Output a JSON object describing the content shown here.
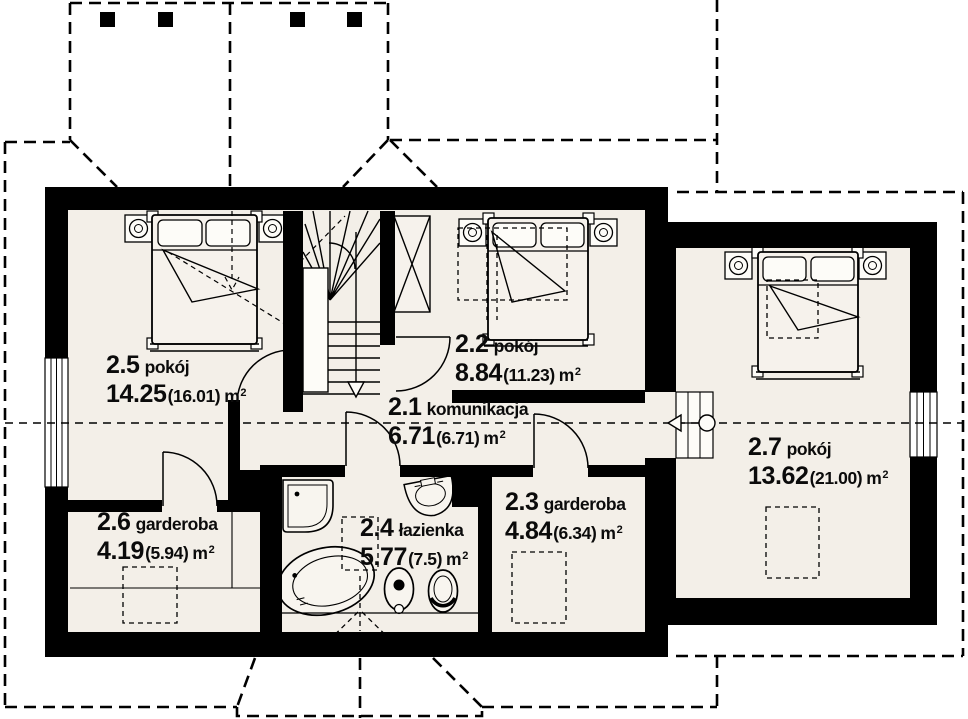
{
  "plan": {
    "drawing_title": "attic floor plan",
    "unit": "m",
    "unit_sup": "2",
    "colors": {
      "wall": "#000000",
      "floor": "#f3efe8",
      "background": "#ffffff",
      "line": "#000000"
    },
    "rooms": [
      {
        "num": "2.1",
        "name": "komunikacja",
        "area": "6.71",
        "area_total": "(6.71)"
      },
      {
        "num": "2.2",
        "name": "pokój",
        "area": "8.84",
        "area_total": "(11.23)"
      },
      {
        "num": "2.3",
        "name": "garderoba",
        "area": "4.84",
        "area_total": "(6.34)"
      },
      {
        "num": "2.4",
        "name": "łazienka",
        "area": "5.77",
        "area_total": "(7.5)"
      },
      {
        "num": "2.5",
        "name": "pokój",
        "area": "14.25",
        "area_total": "(16.01)"
      },
      {
        "num": "2.6",
        "name": "garderoba",
        "area": "4.19",
        "area_total": "(5.94)"
      },
      {
        "num": "2.7",
        "name": "pokój",
        "area": "13.62",
        "area_total": "(21.00)"
      }
    ]
  }
}
